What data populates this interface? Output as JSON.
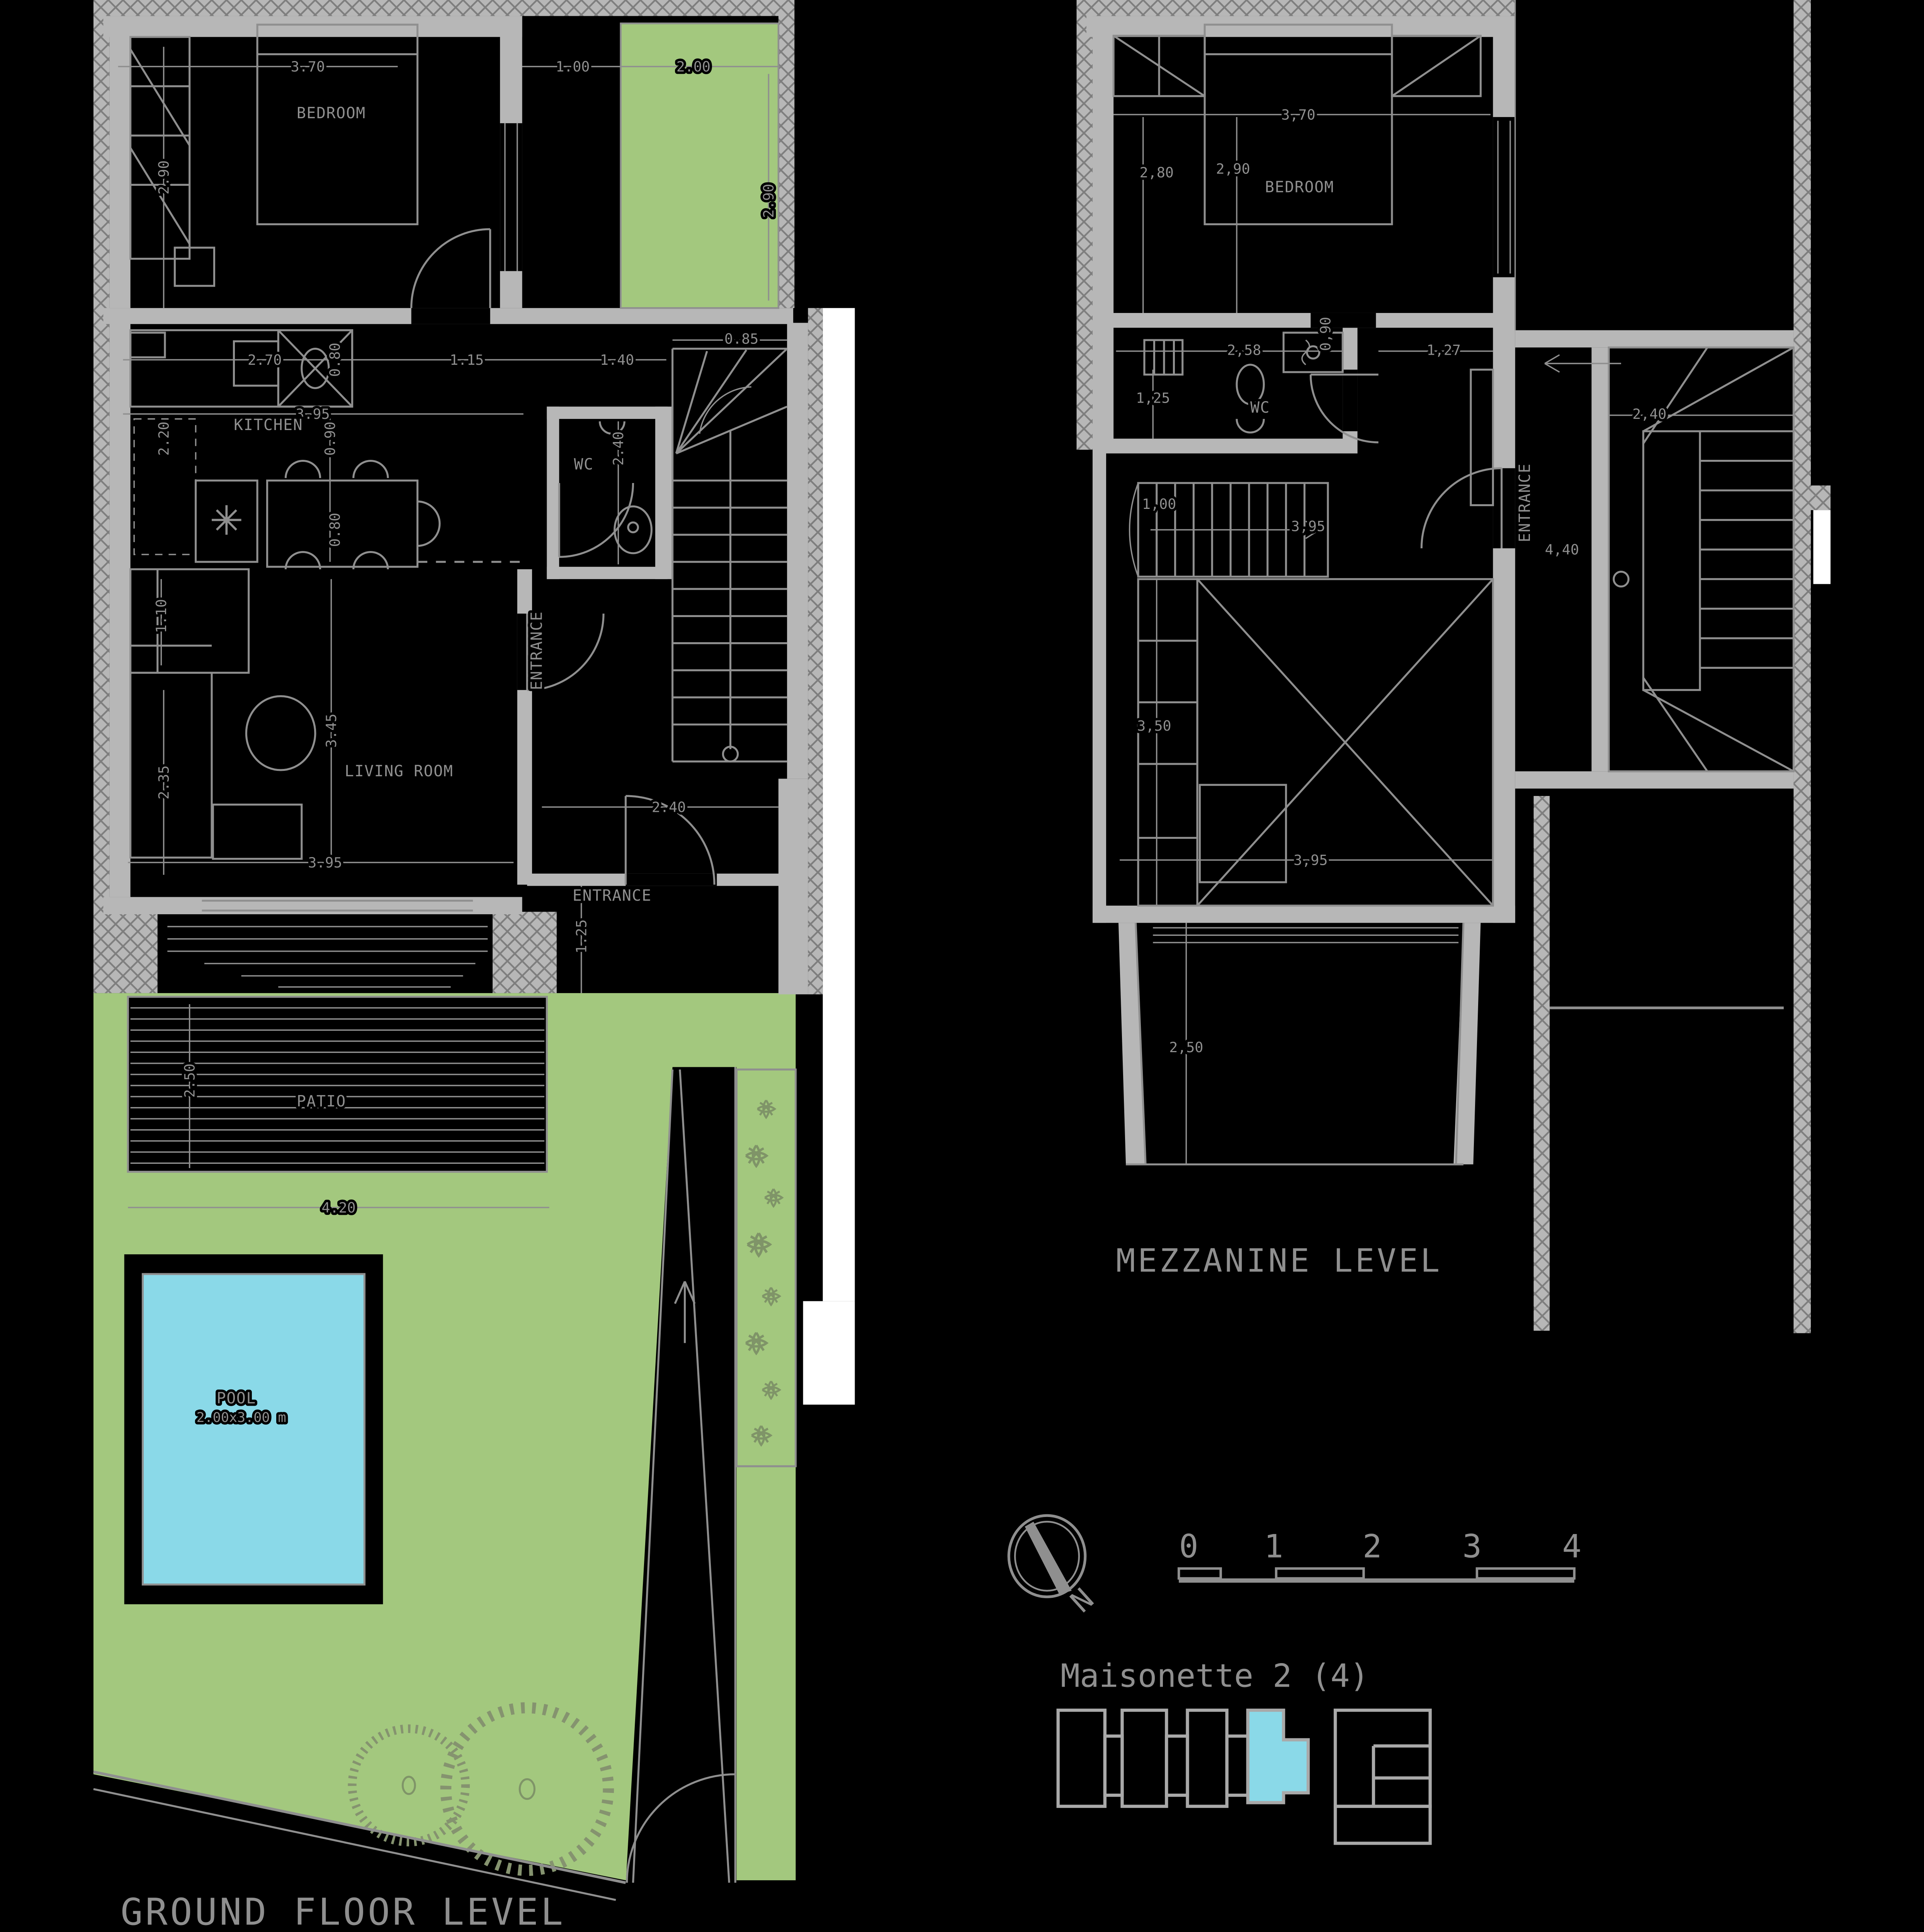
{
  "ground_floor": {
    "title": "GROUND FLOOR LEVEL",
    "rooms": {
      "bedroom": "BEDROOM",
      "kitchen": "KITCHEN",
      "wc": "WC",
      "living": "LIVING ROOM",
      "entrance_side": "ENTRANCE",
      "entrance_front": "ENTRANCE",
      "patio": "PATIO",
      "pool": "POOL",
      "pool_size": "2.00x3.00 m"
    },
    "dims": {
      "bedroom_w": "3.70",
      "bedroom_h": "2.90",
      "balc_a": "1.00",
      "balc_b": "2.00",
      "balc_h": "2.90",
      "kit_a": "2.70",
      "kit_b": "0.80",
      "kit_c": "1.15",
      "kit_d": "1.40",
      "stair_w": "0.85",
      "kit_len": "3.95",
      "kit_e": "0.90",
      "kit_f": "2.20",
      "table": "0.80",
      "wc_h": "2.40",
      "liv_a": "1.10",
      "liv_b": "2.35",
      "liv_c": "3.45",
      "liv_w": "3.95",
      "ent_w": "2.40",
      "ent_d": "1.25",
      "patio_h": "2.50",
      "patio_w": "4.20"
    }
  },
  "mezzanine": {
    "title": "MEZZANINE LEVEL",
    "rooms": {
      "bedroom": "BEDROOM",
      "wc": "WC",
      "entrance": "ENTRANCE"
    },
    "dims": {
      "bed_w": "3,70",
      "bed_a": "2,80",
      "bed_b": "2,90",
      "wc_a": "2,58",
      "wc_b": "0,90",
      "wc_c": "1,27",
      "wc_d": "1,25",
      "stair": "2,40",
      "core": "4,40",
      "fl_a": "1,00",
      "fl_b": "3,95",
      "void_h": "3,50",
      "void_w": "3,95",
      "terr": "2,50"
    }
  },
  "key_plan": {
    "north_label": "N",
    "scale_ticks": [
      "0",
      "1",
      "2",
      "3",
      "4"
    ],
    "unit_label": "Maisonette 2 (4)"
  },
  "colors": {
    "line": "#8f8f8f",
    "wall": "#b7b7b7",
    "green": "#a3c87e",
    "cyan": "#8ad9e8"
  }
}
